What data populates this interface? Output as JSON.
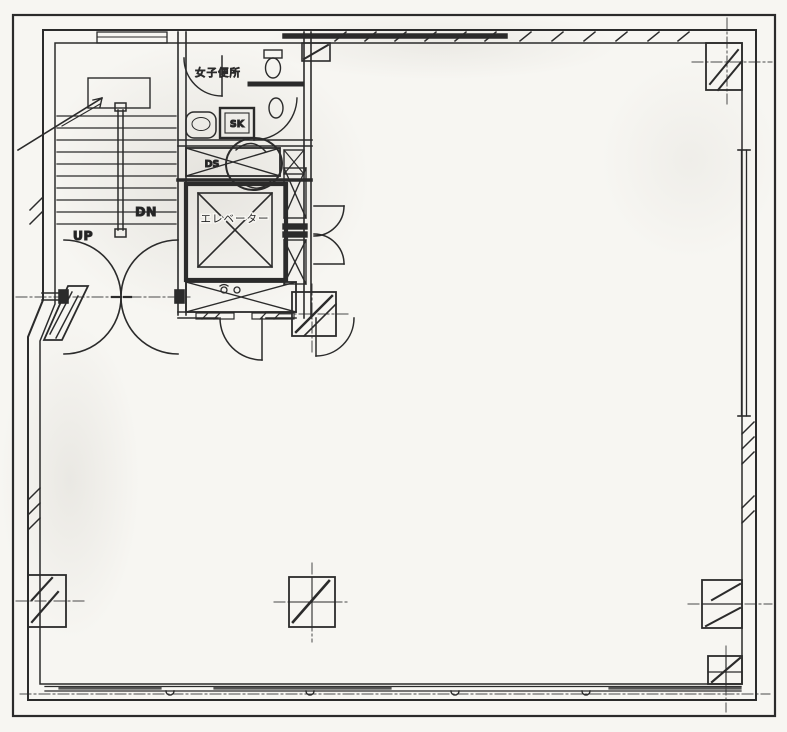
{
  "plan": {
    "labels": {
      "up": "UP",
      "down": "DN",
      "womens_toilet": "女子便所",
      "slop_sink": "SK",
      "duct_space": "DS",
      "elevator": "エレベーター"
    },
    "colors": {
      "ink": "#2b2b2b",
      "paper": "#f7f6f2"
    }
  }
}
